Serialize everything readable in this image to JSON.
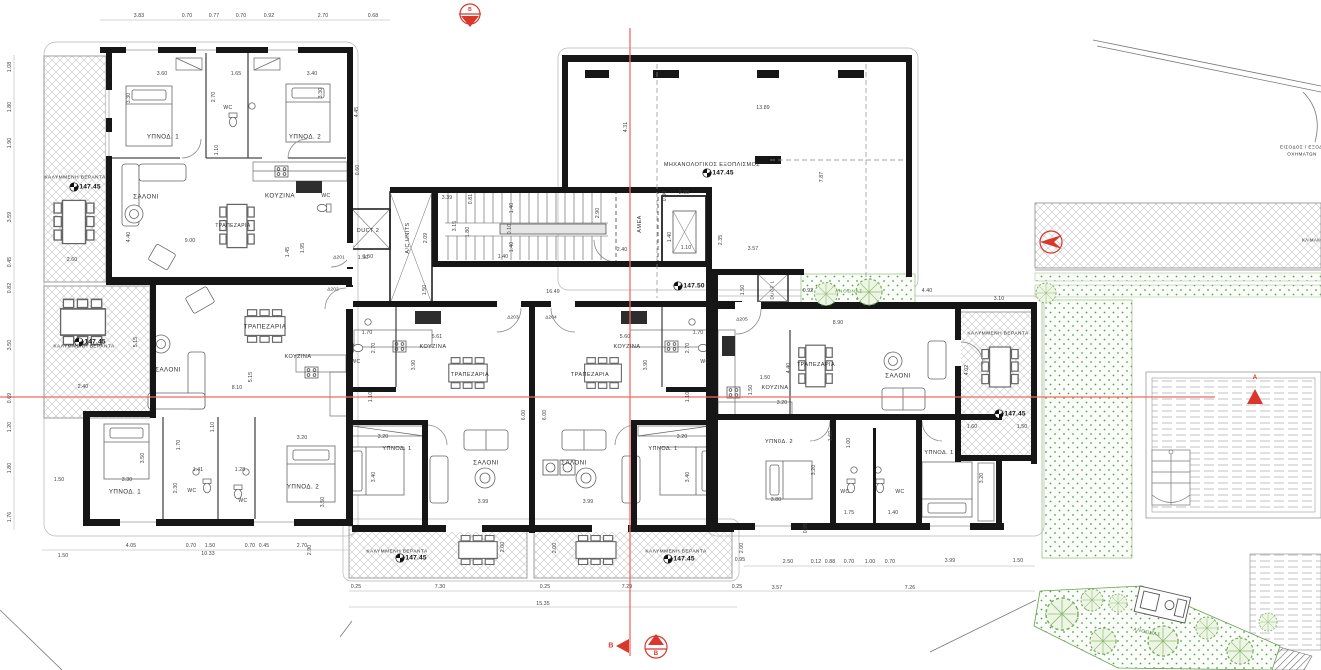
{
  "meta": {
    "drawing_type": "apartment-building floor plan",
    "floor_levels": [
      "+147.45",
      "+147.50"
    ]
  },
  "colors": {
    "walls": "#161616",
    "section_red": "#e8574d",
    "plants_green": "#5a9a46",
    "hatch_gray": "#bdbdbd"
  },
  "units": [
    {
      "id": "Δ201",
      "veranda_level": "+147.45",
      "rooms": [
        "ΥΠΝΟΔ. 1",
        "ΥΠΝΟΔ. 2",
        "WC",
        "ΣΑΛΟΝΙ",
        "ΚΟΥΖΙΝΑ",
        "ΤΡΑΠΕΖΑΡΙΑ",
        "ΚΑΛΥΜΜΕΝΗ ΒΕΡΑΝΤΑ"
      ]
    },
    {
      "id": "Δ202",
      "veranda_level": "+147.45",
      "rooms": [
        "ΥΠΝΟΔ. 1",
        "ΥΠΝΟΔ. 2",
        "WC",
        "WC",
        "ΣΑΛΟΝΙ",
        "ΚΟΥΖΙΝΑ",
        "ΤΡΑΠΕΖΑΡΙΑ",
        "ΚΑΛΥΜΜΕΝΗ ΒΕΡΑΝΤΑ"
      ]
    },
    {
      "id": "Δ203",
      "veranda_level": "+147.45",
      "rooms": [
        "ΥΠΝΟΔ. 1",
        "WC",
        "ΣΑΛΟΝΙ",
        "ΚΟΥΖΙΝΑ",
        "ΤΡΑΠΕΖΑΡΙΑ",
        "ΚΑΛΥΜΜΕΝΗ ΒΕΡΑΝΤΑ"
      ]
    },
    {
      "id": "Δ204",
      "veranda_level": "+147.45",
      "rooms": [
        "ΥΠΝΟΔ. 1",
        "WC",
        "ΣΑΛΟΝΙ",
        "ΚΟΥΖΙΝΑ",
        "ΤΡΑΠΕΖΑΡΙΑ",
        "ΚΑΛΥΜΜΕΝΗ ΒΕΡΑΝΤΑ"
      ]
    },
    {
      "id": "Δ205",
      "veranda_level": "+147.45",
      "rooms": [
        "ΥΠΝΟΔ. 1",
        "ΥΠΝΟΔ. 2",
        "WC",
        "WC",
        "ΣΑΛΟΝΙ",
        "ΚΟΥΖΙΝΑ",
        "ΤΡΑΠΕΖΑΡΙΑ",
        "ΚΑΛΥΜΜΕΝΗ ΒΕΡΑΝΤΑ"
      ]
    }
  ],
  "core": {
    "corridor_level": "+147.50",
    "labels": [
      "DUCT 1",
      "DUCT 2",
      "A/C UNITS",
      "AMEA"
    ],
    "mechanical": {
      "label": "ΜΗΧΑΝΟΛΟΓΙΚΟΣ ΕΞΟΠΛΙΣΜΟΣ",
      "level": "+147.45"
    }
  },
  "site": {
    "vehicle_access": "ΕΙΣΟΔΟΣ / ΕΞΟΔΟΣ ΟΧΗΜΑΤΩΝ",
    "planter_label": "ΑΝΘΩΝΑΣ",
    "section_markers": [
      "A",
      "B"
    ]
  },
  "texts": [
    {
      "t": "ΥΠΝΟΔ. 1",
      "x": 163,
      "y": 137,
      "c": "room"
    },
    {
      "t": "ΥΠΝΟΔ. 2",
      "x": 305,
      "y": 137,
      "c": "room"
    },
    {
      "t": "WC",
      "x": 228,
      "y": 108,
      "c": "room",
      "s": 5
    },
    {
      "t": "ΣΑΛΟΝΙ",
      "x": 146,
      "y": 197,
      "c": "room"
    },
    {
      "t": "ΚΟΥΖΙΝΑ",
      "x": 280,
      "y": 196,
      "c": "room"
    },
    {
      "t": "ΤΡΑΠΕΖΑΡΙΑ",
      "x": 233,
      "y": 226,
      "c": "room",
      "s": 5
    },
    {
      "t": "WC",
      "x": 326,
      "y": 196,
      "c": "room",
      "s": 5
    },
    {
      "t": "ΣΑΛΟΝΙ",
      "x": 168,
      "y": 370,
      "c": "room"
    },
    {
      "t": "ΤΡΑΠΕΖΑΡΙΑ",
      "x": 265,
      "y": 327,
      "c": "room"
    },
    {
      "t": "ΚΟΥΖΙΝΑ",
      "x": 298,
      "y": 357,
      "c": "room",
      "s": 5.5
    },
    {
      "t": "ΥΠΝΟΔ. 1",
      "x": 125,
      "y": 492,
      "c": "room"
    },
    {
      "t": "ΥΠΝΟΔ. 2",
      "x": 303,
      "y": 487,
      "c": "room"
    },
    {
      "t": "WC",
      "x": 192,
      "y": 491,
      "c": "room",
      "s": 5
    },
    {
      "t": "WC",
      "x": 243,
      "y": 501,
      "c": "room",
      "s": 5
    },
    {
      "t": "ΚΟΥΖΙΝΑ",
      "x": 433,
      "y": 347,
      "c": "room",
      "s": 5.5
    },
    {
      "t": "ΤΡΑΠΕΖΑΡΙΑ",
      "x": 470,
      "y": 375,
      "c": "room",
      "s": 5.5
    },
    {
      "t": "ΣΑΛΟΝΙ",
      "x": 486,
      "y": 463,
      "c": "room"
    },
    {
      "t": "ΥΠΝΟΔ. 1",
      "x": 397,
      "y": 449,
      "c": "room",
      "s": 5.5
    },
    {
      "t": "WC",
      "x": 356,
      "y": 362,
      "c": "room",
      "s": 5
    },
    {
      "t": "ΚΟΥΖΙΝΑ",
      "x": 627,
      "y": 347,
      "c": "room",
      "s": 5.5
    },
    {
      "t": "ΤΡΑΠΕΖΑΡΙΑ",
      "x": 590,
      "y": 375,
      "c": "room",
      "s": 5.5
    },
    {
      "t": "ΣΑΛΟΝΙ",
      "x": 574,
      "y": 463,
      "c": "room"
    },
    {
      "t": "ΥΠΝΟΔ. 1",
      "x": 663,
      "y": 449,
      "c": "room",
      "s": 5.5
    },
    {
      "t": "WC",
      "x": 705,
      "y": 362,
      "c": "room",
      "s": 5
    },
    {
      "t": "ΤΡΑΠΕΖΑΡΙΑ",
      "x": 816,
      "y": 365,
      "c": "room",
      "s": 5.5
    },
    {
      "t": "ΚΟΥΖΙΝΑ",
      "x": 775,
      "y": 388,
      "c": "room",
      "s": 5.5
    },
    {
      "t": "ΣΑΛΟΝΙ",
      "x": 898,
      "y": 376,
      "c": "room"
    },
    {
      "t": "ΥΠΝ0Δ. 2",
      "x": 779,
      "y": 442,
      "c": "room",
      "s": 5.5
    },
    {
      "t": "ΥΠΝΟΔ. 1",
      "x": 939,
      "y": 453,
      "c": "room",
      "s": 5.5
    },
    {
      "t": "WC",
      "x": 845,
      "y": 492,
      "c": "room",
      "s": 5
    },
    {
      "t": "WC",
      "x": 900,
      "y": 492,
      "c": "room",
      "s": 5
    },
    {
      "t": "DUCT 2",
      "x": 368,
      "y": 231,
      "c": "room",
      "s": 5.5
    },
    {
      "t": "A/C UNITS",
      "x": 408,
      "y": 238,
      "c": "room",
      "r": -90,
      "s": 5.5
    },
    {
      "t": "AMEA",
      "x": 640,
      "y": 224,
      "c": "room",
      "r": -90,
      "s": 5.5
    },
    {
      "t": "DUCT 1",
      "x": 772,
      "y": 290,
      "c": "room",
      "r": -90,
      "s": 4.5
    },
    {
      "t": "ΜΗΧΑΝΟΛΟΓΙΚΟΣ ΕΞΟΠΛΙΣΜΟΣ",
      "x": 712,
      "y": 165,
      "c": "room",
      "s": 5.5
    },
    {
      "t": "ΚΑΛΥΜΜΕΝΗ ΒΕΡΑΝΤΑ",
      "x": 75,
      "y": 178,
      "c": "room",
      "s": 4.8
    },
    {
      "t": "ΚΑΛΥΜΜΕΝΗ ΒΕΡΑΝΤΑ",
      "x": 84,
      "y": 347,
      "c": "room",
      "s": 4.8
    },
    {
      "t": "ΚΑΛΥΜΜΕΝΗ ΒΕΡΑΝΤΑ",
      "x": 397,
      "y": 552,
      "c": "room",
      "s": 4.8
    },
    {
      "t": "ΚΑΛΥΜΜΕΝΗ ΒΕΡΑΝΤΑ",
      "x": 676,
      "y": 552,
      "c": "room",
      "s": 4.8
    },
    {
      "t": "ΚΑΛΥΜΜΕΝΗ ΒΕΡΑΝΤΑ",
      "x": 998,
      "y": 334,
      "c": "room",
      "s": 4.8
    },
    {
      "t": "ΑΝΘΩΝΑΣ",
      "x": 849,
      "y": 292,
      "c": "green",
      "s": 4.8
    },
    {
      "t": "ΑΝΘΩΝΑΣ",
      "x": 1147,
      "y": 633,
      "c": "green",
      "s": 4.8,
      "r": 12
    },
    {
      "t": "ΕΙΣΟΔΟΣ / ΕΞΟΔΟΣ",
      "x": 1305,
      "y": 147,
      "c": "room",
      "s": 4.6
    },
    {
      "t": "ΟΧΗΜΑΤΩΝ",
      "x": 1302,
      "y": 154,
      "c": "room",
      "s": 4.6
    },
    {
      "t": "ΚΛΙΜΑΚΩ",
      "x": 1313,
      "y": 240,
      "c": "room",
      "s": 4.2
    },
    {
      "t": "+147.45",
      "x": 88,
      "y": 187,
      "c": "elev"
    },
    {
      "t": "+147.45",
      "x": 93,
      "y": 342,
      "c": "elev"
    },
    {
      "t": "+147.50",
      "x": 692,
      "y": 286,
      "c": "elev"
    },
    {
      "t": "+147.45",
      "x": 721,
      "y": 173,
      "c": "elev"
    },
    {
      "t": "+147.45",
      "x": 414,
      "y": 558,
      "c": "elev"
    },
    {
      "t": "+147.45",
      "x": 682,
      "y": 559,
      "c": "elev"
    },
    {
      "t": "+147.45",
      "x": 1013,
      "y": 414,
      "c": "elev"
    },
    {
      "t": "Δ201",
      "x": 339,
      "y": 258,
      "c": "door"
    },
    {
      "t": "Δ202",
      "x": 333,
      "y": 290,
      "c": "door"
    },
    {
      "t": "Δ203",
      "x": 513,
      "y": 318,
      "c": "door"
    },
    {
      "t": "Δ204",
      "x": 551,
      "y": 318,
      "c": "door"
    },
    {
      "t": "Δ205",
      "x": 742,
      "y": 320,
      "c": "door"
    },
    {
      "t": "B",
      "x": 470,
      "y": 10,
      "c": "red",
      "s": 5
    },
    {
      "t": "B",
      "x": 611,
      "y": 646,
      "c": "red"
    },
    {
      "t": "B",
      "x": 656,
      "y": 654,
      "c": "red",
      "s": 6
    },
    {
      "t": "A",
      "x": 1255,
      "y": 378,
      "c": "red",
      "s": 6
    },
    {
      "t": "3.83",
      "x": 139,
      "y": 16,
      "c": "dim"
    },
    {
      "t": "0.70",
      "x": 187,
      "y": 16,
      "c": "dim"
    },
    {
      "t": "0.77",
      "x": 214,
      "y": 16,
      "c": "dim"
    },
    {
      "t": "0.70",
      "x": 241,
      "y": 16,
      "c": "dim"
    },
    {
      "t": "0.92",
      "x": 269,
      "y": 16,
      "c": "dim"
    },
    {
      "t": "2.70",
      "x": 323,
      "y": 16,
      "c": "dim"
    },
    {
      "t": "0.68",
      "x": 373,
      "y": 16,
      "c": "dim"
    },
    {
      "t": "1.08",
      "x": 10,
      "y": 67,
      "c": "dim",
      "r": -90
    },
    {
      "t": "1.80",
      "x": 10,
      "y": 107,
      "c": "dim",
      "r": -90
    },
    {
      "t": "1.90",
      "x": 10,
      "y": 143,
      "c": "dim",
      "r": -90
    },
    {
      "t": "3.59",
      "x": 10,
      "y": 217,
      "c": "dim",
      "r": -90
    },
    {
      "t": "0.45",
      "x": 10,
      "y": 262,
      "c": "dim",
      "r": -90
    },
    {
      "t": "0.82",
      "x": 10,
      "y": 288,
      "c": "dim",
      "r": -90
    },
    {
      "t": "3.50",
      "x": 10,
      "y": 345,
      "c": "dim",
      "r": -90
    },
    {
      "t": "0.69",
      "x": 10,
      "y": 398,
      "c": "dim",
      "r": -90
    },
    {
      "t": "1.20",
      "x": 10,
      "y": 427,
      "c": "dim",
      "r": -90
    },
    {
      "t": "1.80",
      "x": 10,
      "y": 468,
      "c": "dim",
      "r": -90
    },
    {
      "t": "1.76",
      "x": 10,
      "y": 517,
      "c": "dim",
      "r": -90
    },
    {
      "t": "3.60",
      "x": 162,
      "y": 74,
      "c": "dim"
    },
    {
      "t": "1.65",
      "x": 236,
      "y": 74,
      "c": "dim"
    },
    {
      "t": "3.40",
      "x": 312,
      "y": 74,
      "c": "dim"
    },
    {
      "t": "3.30",
      "x": 129,
      "y": 98,
      "c": "dim",
      "r": -90
    },
    {
      "t": "2.70",
      "x": 214,
      "y": 97,
      "c": "dim",
      "r": -90
    },
    {
      "t": "3.30",
      "x": 321,
      "y": 93,
      "c": "dim",
      "r": -90
    },
    {
      "t": "4.45",
      "x": 357,
      "y": 112,
      "c": "dim",
      "r": -90
    },
    {
      "t": "1.10",
      "x": 217,
      "y": 150,
      "c": "dim",
      "r": -90
    },
    {
      "t": "9.00",
      "x": 190,
      "y": 241,
      "c": "dim"
    },
    {
      "t": "4.40",
      "x": 129,
      "y": 237,
      "c": "dim",
      "r": -90
    },
    {
      "t": "0.60",
      "x": 358,
      "y": 170,
      "c": "dim",
      "r": -90
    },
    {
      "t": "1.45",
      "x": 288,
      "y": 252,
      "c": "dim",
      "r": -90
    },
    {
      "t": "1.95",
      "x": 303,
      "y": 248,
      "c": "dim",
      "r": -90
    },
    {
      "t": "1.50",
      "x": 363,
      "y": 258,
      "c": "dim"
    },
    {
      "t": "2.60",
      "x": 72,
      "y": 260,
      "c": "dim"
    },
    {
      "t": "2.40",
      "x": 83,
      "y": 387,
      "c": "dim"
    },
    {
      "t": "5.15",
      "x": 136,
      "y": 342,
      "c": "dim",
      "r": -90
    },
    {
      "t": "5.15",
      "x": 251,
      "y": 377,
      "c": "dim",
      "r": -90
    },
    {
      "t": "8.10",
      "x": 237,
      "y": 388,
      "c": "dim"
    },
    {
      "t": "1.10",
      "x": 213,
      "y": 427,
      "c": "dim",
      "r": -90
    },
    {
      "t": "1.70",
      "x": 179,
      "y": 445,
      "c": "dim",
      "r": -90
    },
    {
      "t": "3.50",
      "x": 143,
      "y": 458,
      "c": "dim",
      "r": -90
    },
    {
      "t": "3.30",
      "x": 127,
      "y": 480,
      "c": "dim"
    },
    {
      "t": "1.41",
      "x": 198,
      "y": 470,
      "c": "dim"
    },
    {
      "t": "1.28",
      "x": 240,
      "y": 470,
      "c": "dim"
    },
    {
      "t": "3.20",
      "x": 302,
      "y": 438,
      "c": "dim"
    },
    {
      "t": "2.30",
      "x": 176,
      "y": 488,
      "c": "dim",
      "r": -90
    },
    {
      "t": "3.50",
      "x": 323,
      "y": 502,
      "c": "dim",
      "r": -90
    },
    {
      "t": "1.50",
      "x": 59,
      "y": 480,
      "c": "dim"
    },
    {
      "t": "3.39",
      "x": 447,
      "y": 198,
      "c": "dim"
    },
    {
      "t": "0.81",
      "x": 471,
      "y": 199,
      "c": "dim",
      "r": -90
    },
    {
      "t": "3.15",
      "x": 455,
      "y": 226,
      "c": "dim",
      "r": -90
    },
    {
      "t": "1.80",
      "x": 468,
      "y": 232,
      "c": "dim",
      "r": -90
    },
    {
      "t": "2.09",
      "x": 426,
      "y": 238,
      "c": "dim",
      "r": -90
    },
    {
      "t": "1.40",
      "x": 512,
      "y": 208,
      "c": "dim",
      "r": -90
    },
    {
      "t": "0.10",
      "x": 510,
      "y": 229,
      "c": "dim",
      "r": -90
    },
    {
      "t": "1.40",
      "x": 512,
      "y": 247,
      "c": "dim",
      "r": -90
    },
    {
      "t": "1.40",
      "x": 503,
      "y": 257,
      "c": "dim"
    },
    {
      "t": "2.90",
      "x": 598,
      "y": 213,
      "c": "dim",
      "r": -90
    },
    {
      "t": "2.40",
      "x": 622,
      "y": 250,
      "c": "dim"
    },
    {
      "t": "2.05",
      "x": 684,
      "y": 193,
      "c": "dim"
    },
    {
      "t": "0.80",
      "x": 665,
      "y": 196,
      "c": "dim",
      "r": -90
    },
    {
      "t": "1.40",
      "x": 670,
      "y": 237,
      "c": "dim",
      "r": -90
    },
    {
      "t": "1.10",
      "x": 686,
      "y": 248,
      "c": "dim"
    },
    {
      "t": "2.35",
      "x": 721,
      "y": 240,
      "c": "dim",
      "r": -90
    },
    {
      "t": "3.57",
      "x": 753,
      "y": 249,
      "c": "dim"
    },
    {
      "t": "16.49",
      "x": 553,
      "y": 292,
      "c": "dim"
    },
    {
      "t": "1.50",
      "x": 368,
      "y": 257,
      "c": "dim"
    },
    {
      "t": "1.50",
      "x": 425,
      "y": 290,
      "c": "dim",
      "r": -90
    },
    {
      "t": "1.50",
      "x": 743,
      "y": 290,
      "c": "dim",
      "r": -90
    },
    {
      "t": "13.89",
      "x": 763,
      "y": 108,
      "c": "dim"
    },
    {
      "t": "4.31",
      "x": 626,
      "y": 127,
      "c": "dim",
      "r": -90
    },
    {
      "t": "7.87",
      "x": 822,
      "y": 177,
      "c": "dim",
      "r": -90
    },
    {
      "t": "5.61",
      "x": 437,
      "y": 337,
      "c": "dim"
    },
    {
      "t": "5.60",
      "x": 625,
      "y": 337,
      "c": "dim"
    },
    {
      "t": "3.90",
      "x": 414,
      "y": 365,
      "c": "dim",
      "r": -90
    },
    {
      "t": "3.90",
      "x": 646,
      "y": 365,
      "c": "dim",
      "r": -90
    },
    {
      "t": "6.00",
      "x": 524,
      "y": 415,
      "c": "dim",
      "r": -90
    },
    {
      "t": "6.00",
      "x": 545,
      "y": 415,
      "c": "dim",
      "r": -90
    },
    {
      "t": "3.99",
      "x": 483,
      "y": 502,
      "c": "dim"
    },
    {
      "t": "3.99",
      "x": 588,
      "y": 502,
      "c": "dim"
    },
    {
      "t": "3.20",
      "x": 383,
      "y": 437,
      "c": "dim"
    },
    {
      "t": "3.20",
      "x": 682,
      "y": 437,
      "c": "dim"
    },
    {
      "t": "3.40",
      "x": 374,
      "y": 477,
      "c": "dim",
      "r": -90
    },
    {
      "t": "3.40",
      "x": 688,
      "y": 477,
      "c": "dim",
      "r": -90
    },
    {
      "t": "1.10",
      "x": 371,
      "y": 397,
      "c": "dim",
      "r": -90
    },
    {
      "t": "1.10",
      "x": 688,
      "y": 397,
      "c": "dim",
      "r": -90
    },
    {
      "t": "2.70",
      "x": 374,
      "y": 348,
      "c": "dim",
      "r": -90
    },
    {
      "t": "2.70",
      "x": 688,
      "y": 348,
      "c": "dim",
      "r": -90
    },
    {
      "t": "1.70",
      "x": 367,
      "y": 333,
      "c": "dim"
    },
    {
      "t": "1.70",
      "x": 698,
      "y": 333,
      "c": "dim"
    },
    {
      "t": "8.90",
      "x": 838,
      "y": 323,
      "c": "dim"
    },
    {
      "t": "3.10",
      "x": 999,
      "y": 299,
      "c": "dim"
    },
    {
      "t": "0.92",
      "x": 808,
      "y": 291,
      "c": "dim"
    },
    {
      "t": "4.40",
      "x": 927,
      "y": 291,
      "c": "dim"
    },
    {
      "t": "4.40",
      "x": 789,
      "y": 368,
      "c": "dim",
      "r": -90
    },
    {
      "t": "1.50",
      "x": 765,
      "y": 378,
      "c": "dim"
    },
    {
      "t": "1.50",
      "x": 751,
      "y": 390,
      "c": "dim",
      "r": -90
    },
    {
      "t": "3.20",
      "x": 782,
      "y": 403,
      "c": "dim"
    },
    {
      "t": "3.80",
      "x": 776,
      "y": 500,
      "c": "dim"
    },
    {
      "t": "1.75",
      "x": 849,
      "y": 513,
      "c": "dim"
    },
    {
      "t": "1.40",
      "x": 893,
      "y": 513,
      "c": "dim"
    },
    {
      "t": "3.20",
      "x": 814,
      "y": 470,
      "c": "dim",
      "r": -90
    },
    {
      "t": "3.20",
      "x": 982,
      "y": 478,
      "c": "dim",
      "r": -90
    },
    {
      "t": "1.60",
      "x": 972,
      "y": 427,
      "c": "dim"
    },
    {
      "t": "1.50",
      "x": 1022,
      "y": 427,
      "c": "dim"
    },
    {
      "t": "4.02",
      "x": 967,
      "y": 370,
      "c": "dim",
      "r": -90
    },
    {
      "t": "1.60",
      "x": 831,
      "y": 436,
      "c": "dim",
      "r": -90
    },
    {
      "t": "1.00",
      "x": 849,
      "y": 443,
      "c": "dim",
      "r": -90
    },
    {
      "t": "0.95",
      "x": 806,
      "y": 528,
      "c": "dim",
      "r": -90
    },
    {
      "t": "1.50",
      "x": 63,
      "y": 556,
      "c": "dim"
    },
    {
      "t": "4.05",
      "x": 131,
      "y": 546,
      "c": "dim"
    },
    {
      "t": "0.70",
      "x": 191,
      "y": 546,
      "c": "dim"
    },
    {
      "t": "1.50",
      "x": 210,
      "y": 546,
      "c": "dim"
    },
    {
      "t": "0.70",
      "x": 250,
      "y": 546,
      "c": "dim"
    },
    {
      "t": "0.45",
      "x": 264,
      "y": 546,
      "c": "dim"
    },
    {
      "t": "2.70",
      "x": 302,
      "y": 546,
      "c": "dim"
    },
    {
      "t": "2.90",
      "x": 310,
      "y": 550,
      "c": "dim",
      "r": -90
    },
    {
      "t": "10.33",
      "x": 208,
      "y": 554,
      "c": "dim"
    },
    {
      "t": "0.25",
      "x": 356,
      "y": 587,
      "c": "dim"
    },
    {
      "t": "7.30",
      "x": 440,
      "y": 587,
      "c": "dim"
    },
    {
      "t": "0.25",
      "x": 545,
      "y": 587,
      "c": "dim"
    },
    {
      "t": "7.29",
      "x": 627,
      "y": 587,
      "c": "dim"
    },
    {
      "t": "0.25",
      "x": 737,
      "y": 587,
      "c": "dim"
    },
    {
      "t": "15.35",
      "x": 543,
      "y": 604,
      "c": "dim"
    },
    {
      "t": "2.00",
      "x": 503,
      "y": 547,
      "c": "dim",
      "r": -90
    },
    {
      "t": "2.00",
      "x": 555,
      "y": 548,
      "c": "dim",
      "r": -90
    },
    {
      "t": "2.00",
      "x": 742,
      "y": 548,
      "c": "dim",
      "r": -90
    },
    {
      "t": "0.95",
      "x": 740,
      "y": 560,
      "c": "dim"
    },
    {
      "t": "2.50",
      "x": 788,
      "y": 562,
      "c": "dim"
    },
    {
      "t": "0.12",
      "x": 816,
      "y": 562,
      "c": "dim"
    },
    {
      "t": "0.88",
      "x": 830,
      "y": 562,
      "c": "dim"
    },
    {
      "t": "0.70",
      "x": 849,
      "y": 562,
      "c": "dim"
    },
    {
      "t": "1.00",
      "x": 870,
      "y": 562,
      "c": "dim"
    },
    {
      "t": "0.70",
      "x": 890,
      "y": 562,
      "c": "dim"
    },
    {
      "t": "3.99",
      "x": 950,
      "y": 561,
      "c": "dim"
    },
    {
      "t": "1.50",
      "x": 1018,
      "y": 561,
      "c": "dim"
    },
    {
      "t": "3.57",
      "x": 777,
      "y": 588,
      "c": "dim"
    },
    {
      "t": "7.26",
      "x": 910,
      "y": 588,
      "c": "dim"
    }
  ]
}
